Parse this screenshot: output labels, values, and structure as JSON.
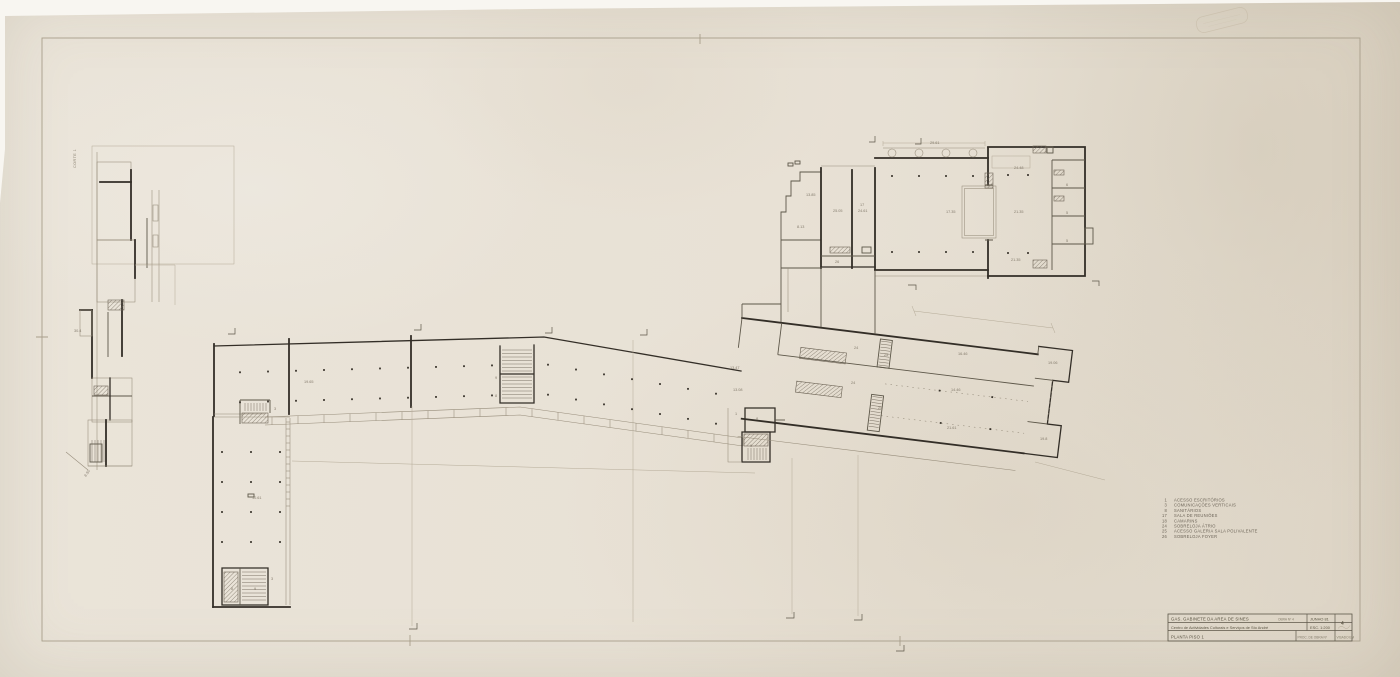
{
  "sheet": {
    "paper_hex": "#e8e1d5",
    "ink_hex": "#332e27",
    "thin_ink_hex": "#968c7a",
    "backdrop_hex": "#f8f6f1"
  },
  "side_label": "CORTE 1",
  "legend": {
    "items": [
      {
        "num": "1",
        "label": "ACESSO ESCRITÓRIOS"
      },
      {
        "num": "3",
        "label": "COMUNICAÇÕES VERTICAIS"
      },
      {
        "num": "8",
        "label": "SANITÁRIOS"
      },
      {
        "num": "17",
        "label": "SALA DE REUNIÕES"
      },
      {
        "num": "18",
        "label": "CAMARINS"
      },
      {
        "num": "24",
        "label": "SOBRELOJA ÁTRIO"
      },
      {
        "num": "25",
        "label": "ACESSO GALERIA SALA POLIVALENTE"
      },
      {
        "num": "26",
        "label": "SOBRELOJA FOYER"
      }
    ]
  },
  "title_block": {
    "org": "GAS. GABINETE DA AREA DE SINES",
    "obra_ref": "OBRA Nº 4",
    "date": "JUNHO  81",
    "sheet_no": "4",
    "project": "Centro de Actividades Culturais e Serviços de Sto André",
    "scale": "ESC.  1:200",
    "drawing": "PLANTA PISO  1",
    "process_ref": "PROC. DE OBRA Nº",
    "visa": "VISADO EM"
  },
  "plan_labels": [
    {
      "x": 274,
      "y": 410,
      "t": "3"
    },
    {
      "x": 495,
      "y": 379,
      "t": "9"
    },
    {
      "x": 495,
      "y": 397,
      "t": "8"
    },
    {
      "x": 304,
      "y": 383,
      "t": "19.65"
    },
    {
      "x": 252,
      "y": 499,
      "t": "10.61"
    },
    {
      "x": 231,
      "y": 590,
      "t": "8"
    },
    {
      "x": 254,
      "y": 590,
      "t": "9"
    },
    {
      "x": 271,
      "y": 580,
      "t": "3"
    },
    {
      "x": 735,
      "y": 415,
      "t": "1"
    },
    {
      "x": 756,
      "y": 420,
      "t": "8"
    },
    {
      "x": 750,
      "y": 447,
      "t": "9"
    },
    {
      "x": 730,
      "y": 369,
      "t": "13.47"
    },
    {
      "x": 733,
      "y": 391,
      "t": "13.08"
    },
    {
      "x": 854,
      "y": 349,
      "t": "24"
    },
    {
      "x": 851,
      "y": 384,
      "t": "24"
    },
    {
      "x": 884,
      "y": 356,
      "t": "25"
    },
    {
      "x": 878,
      "y": 409,
      "t": "25"
    },
    {
      "x": 958,
      "y": 355,
      "t": "16.46"
    },
    {
      "x": 951,
      "y": 391,
      "t": "14.46"
    },
    {
      "x": 947,
      "y": 429,
      "t": "21.61"
    },
    {
      "x": 1048,
      "y": 364,
      "t": "19.06"
    },
    {
      "x": 1040,
      "y": 440,
      "t": "19.8"
    },
    {
      "x": 833,
      "y": 212,
      "t": "25.05"
    },
    {
      "x": 860,
      "y": 206,
      "t": "17"
    },
    {
      "x": 858,
      "y": 212,
      "t": "24.61"
    },
    {
      "x": 806,
      "y": 196,
      "t": "13.85"
    },
    {
      "x": 797,
      "y": 228,
      "t": "8.13"
    },
    {
      "x": 835,
      "y": 263,
      "t": "26"
    },
    {
      "x": 1014,
      "y": 169,
      "t": "24.48"
    },
    {
      "x": 1014,
      "y": 213,
      "t": "21.35"
    },
    {
      "x": 1011,
      "y": 261,
      "t": "21.35"
    },
    {
      "x": 1066,
      "y": 186,
      "t": "6"
    },
    {
      "x": 1066,
      "y": 214,
      "t": "5"
    },
    {
      "x": 1066,
      "y": 242,
      "t": "5"
    },
    {
      "x": 946,
      "y": 213,
      "t": "17.35"
    },
    {
      "x": 930,
      "y": 144,
      "t": "29.61"
    },
    {
      "x": 74,
      "y": 332,
      "t": "30.4"
    },
    {
      "x": 86,
      "y": 477,
      "t": "8.50",
      "r": -55
    }
  ]
}
